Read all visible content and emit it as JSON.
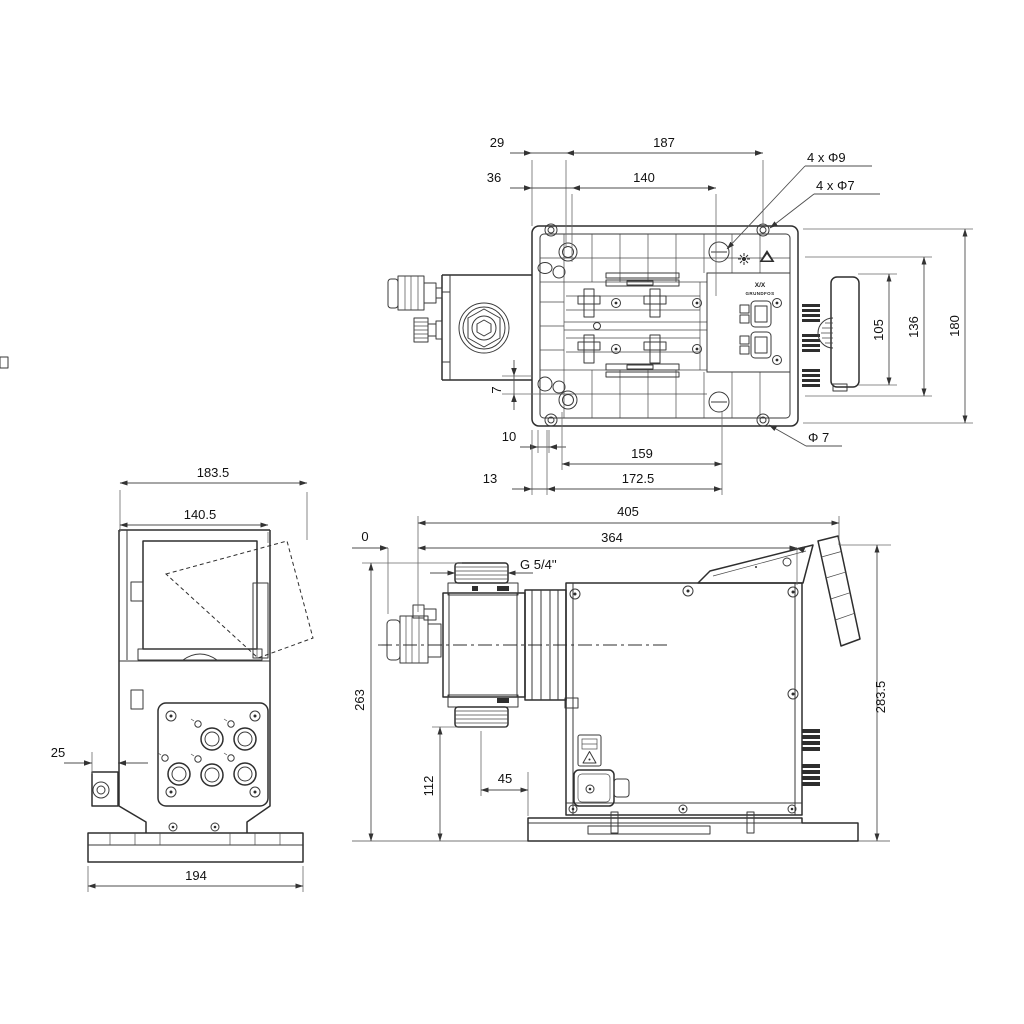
{
  "title": "Dosing pump dimensional drawing",
  "colors": {
    "background": "#ffffff",
    "line": "#2e2e2e",
    "dimension": "#4d4d4d",
    "text": "#111111"
  },
  "tv": {
    "d29": "29",
    "d187": "187",
    "d36": "36",
    "d140": "140",
    "h9": "4 x Φ9",
    "h7": "4 x Φ7",
    "d105": "105",
    "d136": "136",
    "d180": "180",
    "d7": "7",
    "d10": "10",
    "d159": "159",
    "d13": "13",
    "d1725": "172.5",
    "dia7": "Φ 7",
    "marking": "X/X",
    "brand": "GRUNDFOS"
  },
  "fv": {
    "d1835": "183.5",
    "d1405": "140.5",
    "d25": "25",
    "d194": "194"
  },
  "sv": {
    "d405": "405",
    "d364": "364",
    "d0": "0",
    "thread": "G 5/4''",
    "d263": "263",
    "d112": "112",
    "d45": "45",
    "d2835": "283.5"
  }
}
